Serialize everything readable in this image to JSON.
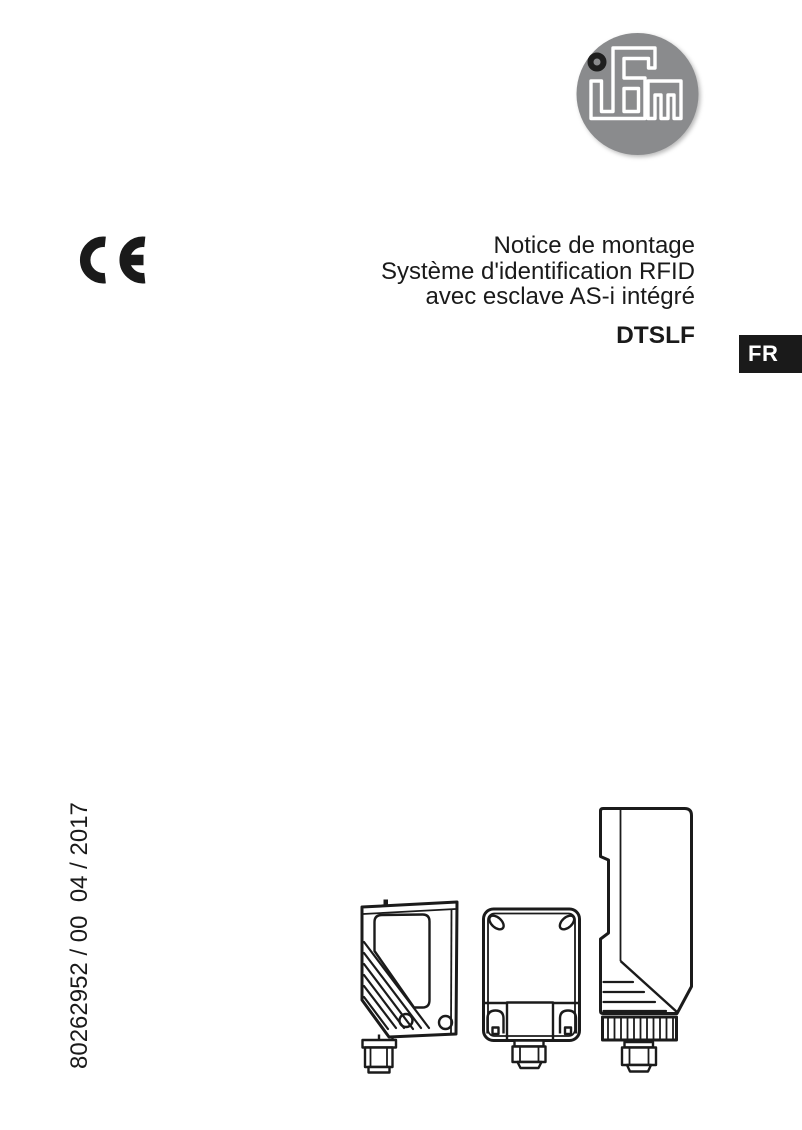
{
  "page": {
    "background": "#ffffff",
    "text_color": "#1a1a1a"
  },
  "logo": {
    "name": "ifm logo",
    "letters": "ifm",
    "circle_color": "#8a8b8d",
    "letter_color": "#ffffff",
    "dot_color": "#1f1f1f"
  },
  "ce_mark": {
    "label": "CE",
    "color": "#1a1a1a"
  },
  "title": {
    "lines": [
      "Notice de montage",
      "Système d'identification RFID",
      "avec esclave AS-i intégré"
    ],
    "product_code": "DTSLF"
  },
  "language_badge": {
    "label": "FR",
    "bg": "#1a1a1a",
    "fg": "#ffffff"
  },
  "document_number": {
    "text": "80262952 / 00  04 / 2017"
  },
  "illustrations": {
    "description": "three RFID system device line drawings",
    "devices": [
      "compact-sensor-head-with-m12-connector",
      "flat-rfid-antenna-with-m12-connector",
      "din-rail-evaluation-unit-with-m12-connector"
    ]
  }
}
